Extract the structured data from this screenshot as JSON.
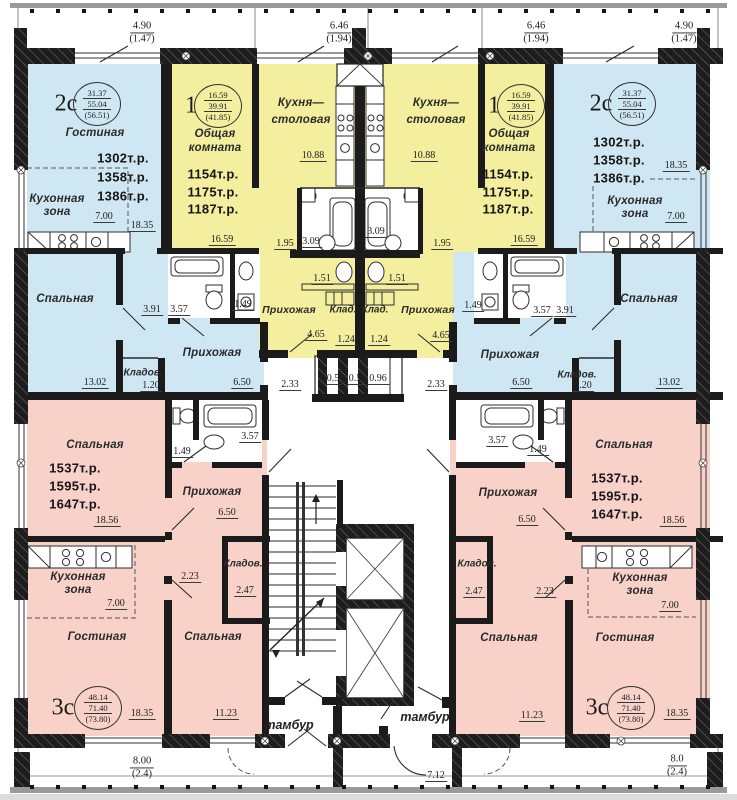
{
  "top_dimensions": [
    {
      "value": "4.90",
      "sub": "(1.47)"
    },
    {
      "value": "6.46",
      "sub": "(1.94)"
    },
    {
      "value": "6.46",
      "sub": "(1.94)"
    },
    {
      "value": "4.90",
      "sub": "(1.47)"
    }
  ],
  "bottom_dimensions": [
    {
      "value": "8.00",
      "sub": "(2.4)"
    },
    {
      "value": "7.12",
      "sub": ""
    },
    {
      "value": "8.0",
      "sub": "(2.4)"
    }
  ],
  "colors": {
    "one_room": "#f3ef9e",
    "two_room": "#cfe6f3",
    "three_room": "#f8d2c9",
    "wall": "#1b1b1b"
  },
  "apartments": {
    "two_room_left": {
      "type": "2с",
      "area_circle": [
        "31.37",
        "55.04",
        "(56.51)"
      ],
      "prices": [
        "1302т.р.",
        "1358т.р.",
        "1386т.р."
      ],
      "living": "Гостиная",
      "living_dim": "18.35",
      "kitchen_1": "Кухонная",
      "kitchen_2": "зона",
      "kitchen_dim": "7.00",
      "bedroom": "Спальная",
      "bedroom_dim": "13.02",
      "hall": "Прихожая",
      "hall_dim": "6.50",
      "closet": "Кладов.",
      "closet_dim": "1.20",
      "bath_dim_1": "3.91",
      "bath_dim_2": "3.57",
      "wc_dim": "1.49"
    },
    "one_room_left": {
      "type": "1",
      "area_circle": [
        "16.59",
        "39.91",
        "(41.85)"
      ],
      "prices": [
        "1154т.р.",
        "1175т.р.",
        "1187т.р."
      ],
      "main_1": "Общая",
      "main_2": "комната",
      "main_dim": "16.59",
      "kitchen_1": "Кухня—",
      "kitchen_2": "столовая",
      "kitchen_dim": "10.88",
      "hall": "Прихожая",
      "hall_dim": "4.65",
      "closet": "Клад.",
      "closet_dim": "1.24",
      "dim_195": "1.95",
      "dim_309": "3.09",
      "dim_151": "1.51"
    },
    "one_room_right": {
      "type": "1",
      "area_circle": [
        "16.59",
        "39.91",
        "(41.85)"
      ],
      "prices": [
        "1154т.р.",
        "1175т.р.",
        "1187т.р."
      ],
      "main_1": "Общая",
      "main_2": "комната",
      "main_dim": "16.59",
      "kitchen_1": "Кухня—",
      "kitchen_2": "столовая",
      "kitchen_dim": "10.88",
      "hall": "Прихожая",
      "hall_dim": "4.65",
      "closet": "Клад.",
      "closet_dim": "1.24",
      "dim_195": "1.95",
      "dim_309": "3.09",
      "dim_151": "1.51"
    },
    "two_room_right": {
      "type": "2с",
      "area_circle": [
        "31.37",
        "55.04",
        "(56.51)"
      ],
      "prices": [
        "1302т.р.",
        "1358т.р.",
        "1386т.р."
      ],
      "living_dim": "18.35",
      "kitchen_1": "Кухонная",
      "kitchen_2": "зона",
      "kitchen_dim": "7.00",
      "bedroom": "Спальная",
      "bedroom_dim": "13.02",
      "hall": "Прихожая",
      "hall_dim": "6.50",
      "closet": "Кладов.",
      "closet_dim": "1.20",
      "bath_dim_1": "3.57",
      "bath_dim_2": "3.91",
      "wc_dim": "1.49"
    },
    "three_room_left": {
      "type": "3с",
      "area_circle": [
        "48.14",
        "71.40",
        "(73.80)"
      ],
      "prices": [
        "1537т.р.",
        "1595т.р.",
        "1647т.р."
      ],
      "bedroom1": "Спальная",
      "bedroom1_dim": "18.56",
      "hall": "Прихожая",
      "hall_dim": "6.50",
      "kitchen_1": "Кухонная",
      "kitchen_2": "зона",
      "kitchen_dim": "7.00",
      "living": "Гостиная",
      "living_dim": "18.35",
      "bedroom2": "Спальная",
      "bedroom2_dim": "11.23",
      "closet": "Кладов.",
      "closet_dim": "2.47",
      "wc_dim": "1.49",
      "bath_dim": "3.57",
      "door_dim": "2.23"
    },
    "three_room_right": {
      "type": "3с",
      "area_circle": [
        "48.14",
        "71.40",
        "(73.80)"
      ],
      "prices": [
        "1537т.р.",
        "1595т.р.",
        "1647т.р."
      ],
      "bedroom1": "Спальная",
      "bedroom1_dim": "18.56",
      "hall": "Прихожая",
      "hall_dim": "6.50",
      "kitchen_1": "Кухонная",
      "kitchen_2": "зона",
      "kitchen_dim": "7.00",
      "living": "Гостиная",
      "living_dim": "18.35",
      "bedroom2": "Спальная",
      "bedroom2_dim": "11.23",
      "closet": "Кладов.",
      "closet_dim": "2.47",
      "wc_dim": "1.49",
      "bath_dim": "3.57",
      "door_dim": "2.23"
    }
  },
  "common_areas": {
    "vestibule_left": "тамбур",
    "vestibule_right": "тамбур",
    "corridor_dim": "2.33",
    "shaft_dim_1": "0.5",
    "shaft_dim_2": "0.5",
    "shaft_dim_3": "0.96"
  }
}
